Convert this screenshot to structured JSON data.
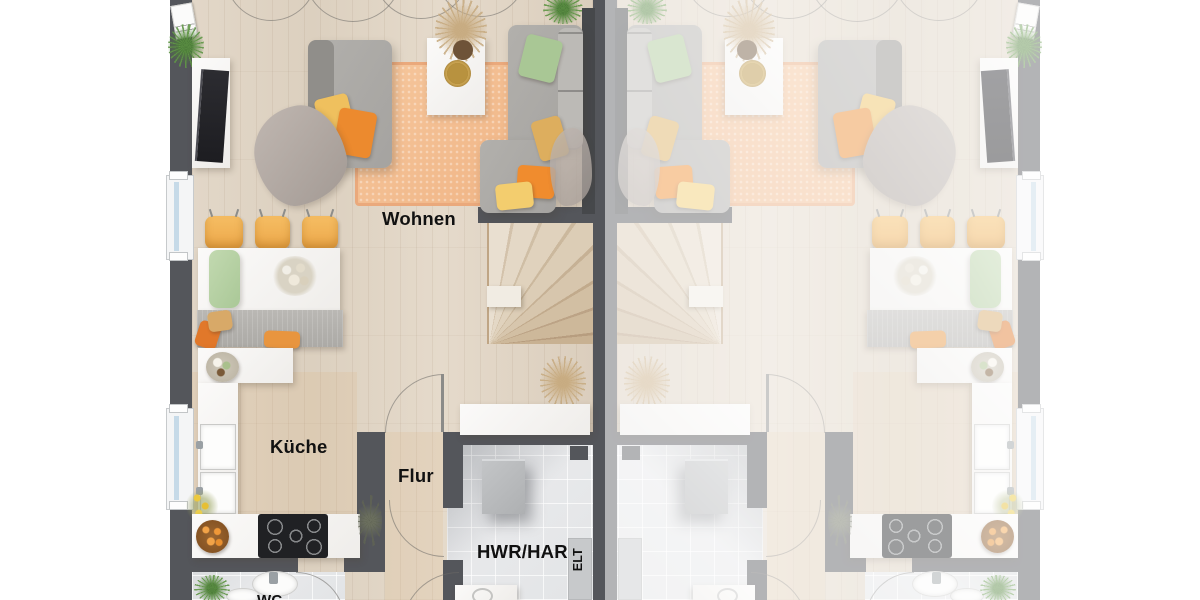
{
  "rooms": {
    "living": "Wohnen",
    "kitchen": "Küche",
    "hallway": "Flur",
    "utility": "HWR/HAR",
    "electrical": "ELT",
    "toilet": "WC"
  },
  "colors": {
    "wall": "#54565b",
    "wood_floor": "#e0d5c5",
    "tile_floor": "#e6e7e9",
    "rug": "#f3bd92",
    "accent_orange": "#ec8a2e",
    "accent_yellow": "#efc05e",
    "accent_green": "#a9c795",
    "stair_wood": "#d8c7b0",
    "label_text": "#111111"
  }
}
